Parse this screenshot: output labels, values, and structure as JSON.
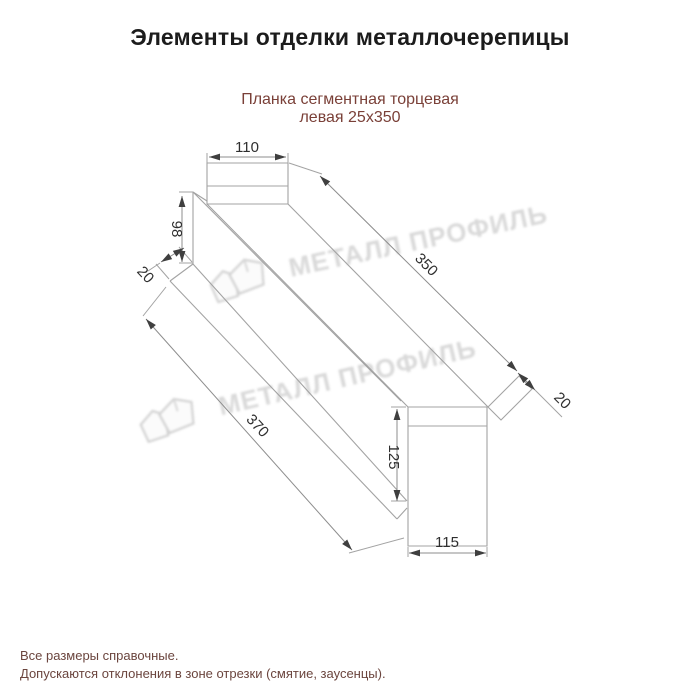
{
  "page": {
    "title": "Элементы отделки металлочерепицы"
  },
  "product": {
    "subtitle_line1": "Планка сегментная торцевая",
    "subtitle_line2": "левая 25х350"
  },
  "dimensions": {
    "top_width": "110",
    "left_height": "98",
    "left_hem": "20",
    "face_length": "350",
    "total_length": "370",
    "right_hem": "20",
    "right_height": "125",
    "bottom_width": "115"
  },
  "watermark": {
    "text": "МЕТАЛЛ ПРОФИЛЬ"
  },
  "notes": {
    "line1": "Все размеры справочные.",
    "line2": "Допускаются отклонения в зоне отрезки (смятие, заусенцы)."
  },
  "colors": {
    "accent_text": "#7a4038",
    "drawing_line": "#a3a3a3",
    "dimension_text": "#2f2f2f",
    "watermark_gray": "#d7d7d7"
  }
}
